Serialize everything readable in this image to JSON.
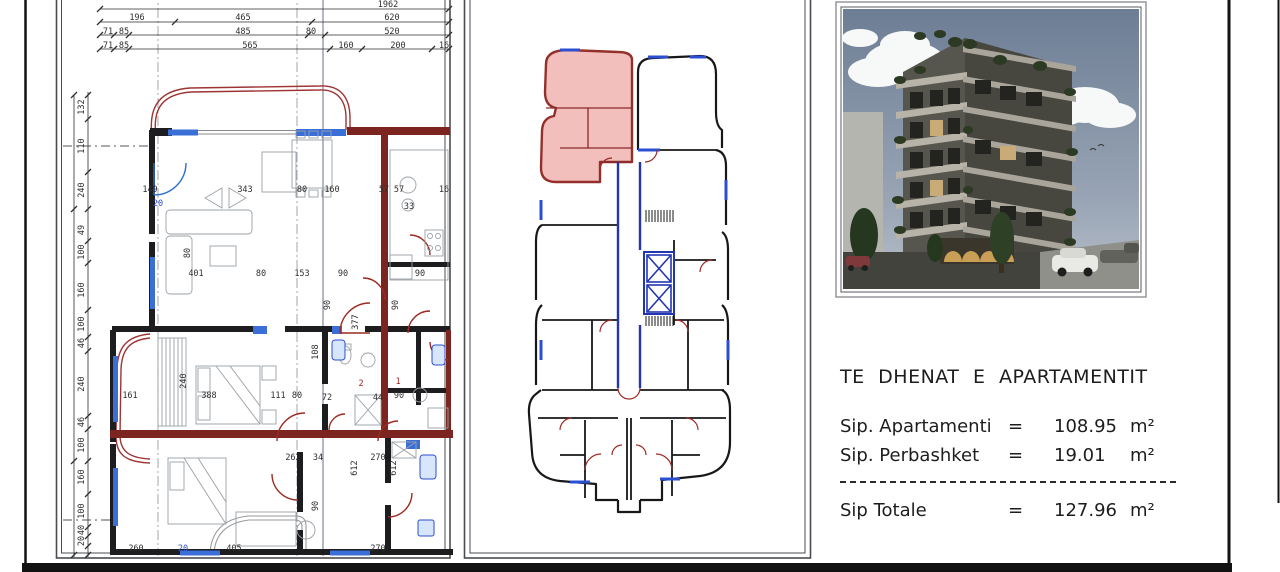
{
  "info_panel": {
    "title": "TE DHENAT E APARTAMENTIT",
    "rows": [
      {
        "label": "Sip. Apartamenti",
        "eq": "=",
        "value": "108.95",
        "unit": "m²"
      },
      {
        "label": "Sip. Perbashket",
        "eq": "=",
        "value": "19.01",
        "unit": "m²"
      }
    ],
    "total_row": {
      "label": "Sip Totale",
      "eq": "=",
      "value": "127.96",
      "unit": "m²"
    }
  },
  "key_plan": {
    "highlight_meaning": "apartment location on floor",
    "highlight_fill": "#f0b4b2",
    "highlight_stroke": "#93302c"
  },
  "colors": {
    "wall": "#1d1d1f",
    "maroon_wall": "#7c2420",
    "window_blue": "#2b4fd0",
    "door_red": "#9c2b24",
    "dim_text": "#2e2e2e"
  },
  "detail_plan": {
    "dim_labels": [
      {
        "t": "1962",
        "x": 388,
        "y": 7
      },
      {
        "t": "196",
        "x": 137,
        "y": 20
      },
      {
        "t": "465",
        "x": 243,
        "y": 20
      },
      {
        "t": "620",
        "x": 392,
        "y": 20
      },
      {
        "t": "71",
        "x": 108,
        "y": 34
      },
      {
        "t": "85",
        "x": 124,
        "y": 34
      },
      {
        "t": "485",
        "x": 243,
        "y": 34
      },
      {
        "t": "80",
        "x": 311,
        "y": 34
      },
      {
        "t": "520",
        "x": 392,
        "y": 34
      },
      {
        "t": "71",
        "x": 108,
        "y": 48
      },
      {
        "t": "85",
        "x": 124,
        "y": 48
      },
      {
        "t": "565",
        "x": 250,
        "y": 48
      },
      {
        "t": "160",
        "x": 346,
        "y": 48
      },
      {
        "t": "200",
        "x": 398,
        "y": 48
      },
      {
        "t": "16",
        "x": 444,
        "y": 48
      },
      {
        "t": "132",
        "x": 84,
        "y": 107,
        "v": 1
      },
      {
        "t": "110",
        "x": 84,
        "y": 146,
        "v": 1
      },
      {
        "t": "240",
        "x": 84,
        "y": 190,
        "v": 1
      },
      {
        "t": "49",
        "x": 84,
        "y": 230,
        "v": 1
      },
      {
        "t": "100",
        "x": 84,
        "y": 252,
        "v": 1
      },
      {
        "t": "160",
        "x": 84,
        "y": 290,
        "v": 1
      },
      {
        "t": "100",
        "x": 84,
        "y": 324,
        "v": 1
      },
      {
        "t": "46",
        "x": 84,
        "y": 343,
        "v": 1
      },
      {
        "t": "240",
        "x": 84,
        "y": 384,
        "v": 1
      },
      {
        "t": "46",
        "x": 84,
        "y": 422,
        "v": 1
      },
      {
        "t": "100",
        "x": 84,
        "y": 445,
        "v": 1
      },
      {
        "t": "160",
        "x": 84,
        "y": 477,
        "v": 1
      },
      {
        "t": "100",
        "x": 84,
        "y": 511,
        "v": 1
      },
      {
        "t": "40",
        "x": 84,
        "y": 530,
        "v": 1
      },
      {
        "t": "20",
        "x": 84,
        "y": 541,
        "v": 1
      },
      {
        "t": "149",
        "x": 150,
        "y": 192
      },
      {
        "t": "343",
        "x": 245,
        "y": 192
      },
      {
        "t": "80",
        "x": 302,
        "y": 192
      },
      {
        "t": "160",
        "x": 332,
        "y": 192
      },
      {
        "t": "57",
        "x": 384,
        "y": 192
      },
      {
        "t": "57",
        "x": 399,
        "y": 192
      },
      {
        "t": "16",
        "x": 444,
        "y": 192
      },
      {
        "t": "33",
        "x": 409,
        "y": 209
      },
      {
        "t": "20",
        "x": 158,
        "y": 206,
        "c": "b"
      },
      {
        "t": "401",
        "x": 196,
        "y": 276
      },
      {
        "t": "80",
        "x": 261,
        "y": 276
      },
      {
        "t": "153",
        "x": 302,
        "y": 276
      },
      {
        "t": "90",
        "x": 343,
        "y": 276
      },
      {
        "t": "90",
        "x": 420,
        "y": 276
      },
      {
        "t": "161",
        "x": 130,
        "y": 398
      },
      {
        "t": "388",
        "x": 209,
        "y": 398
      },
      {
        "t": "111",
        "x": 278,
        "y": 398
      },
      {
        "t": "80",
        "x": 297,
        "y": 398
      },
      {
        "t": "72",
        "x": 327,
        "y": 400
      },
      {
        "t": "44",
        "x": 378,
        "y": 400
      },
      {
        "t": "90",
        "x": 399,
        "y": 398
      },
      {
        "t": "262",
        "x": 293,
        "y": 460
      },
      {
        "t": "34",
        "x": 318,
        "y": 460
      },
      {
        "t": "270",
        "x": 378,
        "y": 460
      },
      {
        "t": "260",
        "x": 136,
        "y": 551
      },
      {
        "t": "405",
        "x": 234,
        "y": 551
      },
      {
        "t": "270",
        "x": 378,
        "y": 551
      },
      {
        "t": "20",
        "x": 183,
        "y": 551,
        "c": "b"
      },
      {
        "t": "80",
        "x": 190,
        "y": 253,
        "v": 1
      },
      {
        "t": "377",
        "x": 358,
        "y": 322,
        "v": 1
      },
      {
        "t": "108",
        "x": 318,
        "y": 352,
        "v": 1
      },
      {
        "t": "240",
        "x": 186,
        "y": 381,
        "v": 1
      },
      {
        "t": "90",
        "x": 330,
        "y": 305,
        "v": 1
      },
      {
        "t": "90",
        "x": 398,
        "y": 305,
        "v": 1
      },
      {
        "t": "612",
        "x": 357,
        "y": 468,
        "v": 1
      },
      {
        "t": "612",
        "x": 396,
        "y": 468,
        "v": 1
      },
      {
        "t": "90",
        "x": 318,
        "y": 506,
        "v": 1
      },
      {
        "t": "2",
        "x": 361,
        "y": 386,
        "c": "r",
        "s": 11
      },
      {
        "t": "1",
        "x": 398,
        "y": 384,
        "c": "r",
        "s": 11
      }
    ]
  }
}
